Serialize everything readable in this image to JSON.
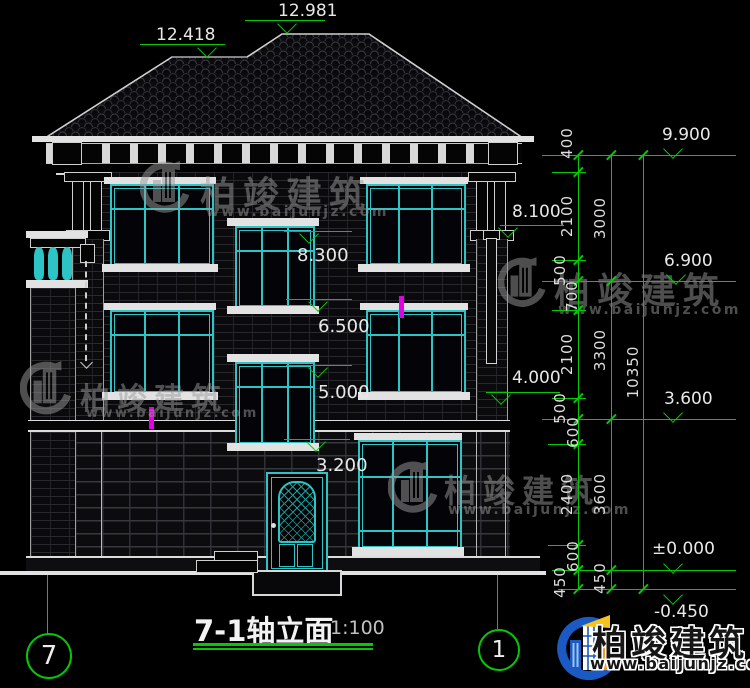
{
  "title": {
    "text": "7-1轴立面",
    "scale": "1:100"
  },
  "axis_bubbles": {
    "left": "7",
    "right": "1"
  },
  "elevation_marks": {
    "ridge_main": "12.981",
    "ridge_wing": "12.418",
    "parapet_right": "8.100",
    "stair_window_head_3f": "8.300",
    "stair_window_sill_3f": "6.500",
    "stair_window_head_2f": "5.000",
    "ledge_right": "4.000",
    "stair_window_sill_2f": "3.200",
    "eave_level": "9.900",
    "level_6900": "6.900",
    "level_3600": "3.600",
    "ground_level": "±0.000",
    "site_level": "-0.450"
  },
  "dimension_chains": {
    "inner": [
      "400",
      "2100",
      "500",
      "700",
      "2100",
      "500",
      "600",
      "2400",
      "600",
      "450"
    ],
    "middle": [
      "3000",
      "3300",
      "3600",
      "450"
    ],
    "overall": [
      "10350"
    ]
  },
  "watermark": {
    "brand": "柏竣建筑",
    "website": "www.baijunjz.com"
  },
  "footer_logo": {
    "brand": "柏竣建筑",
    "website": "www.baijunjz.com"
  },
  "colors": {
    "annotation_green": "#05c805",
    "window_teal": "#2cc4c4",
    "drawing_white": "#e2e2e2",
    "highlight_magenta": "#e400e4",
    "logo_blue": "#1b5ac2",
    "logo_orange": "#f59a1d"
  }
}
